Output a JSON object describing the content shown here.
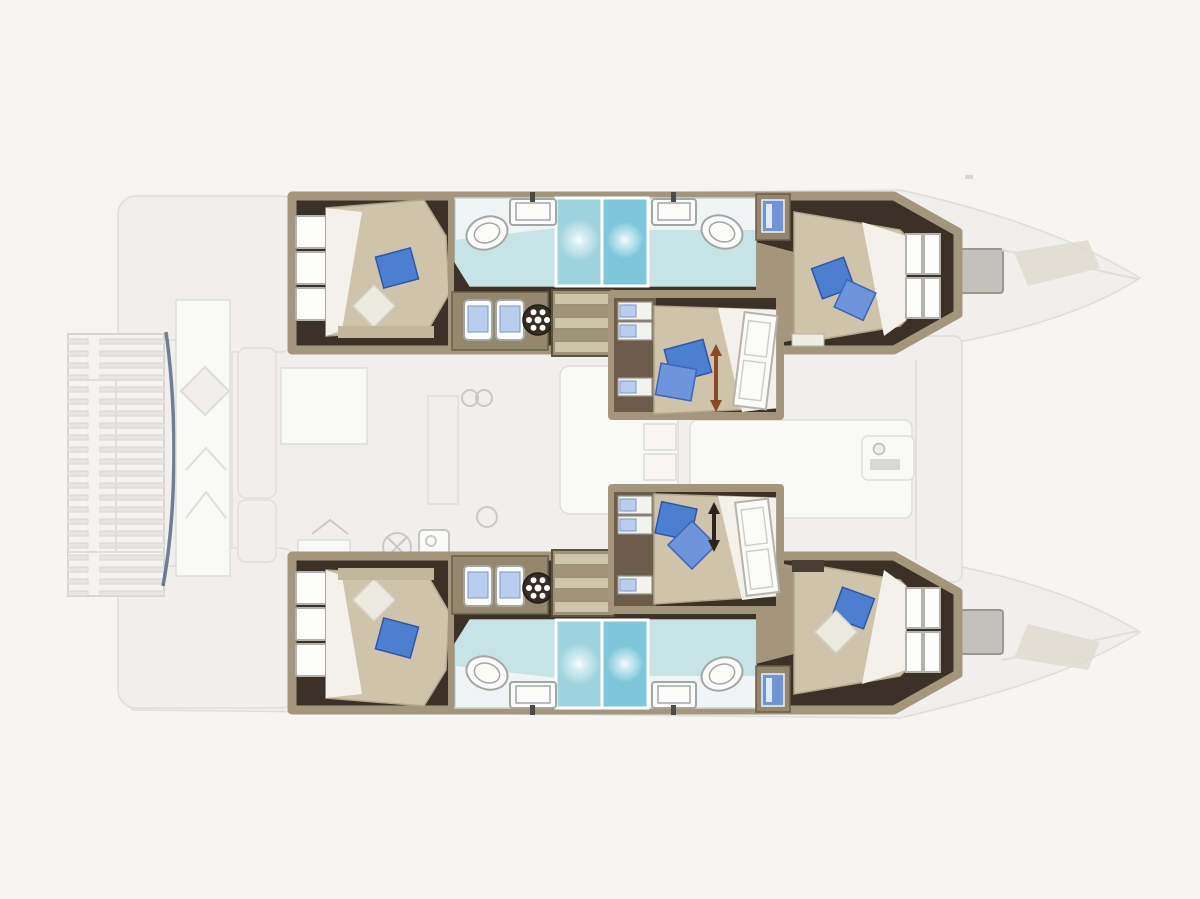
{
  "page": {
    "description": "Top-down interior layout plan of a sailing catamaran: six double cabins, four bathrooms with showers, twin staircases, saloon and galley (upper deck shown faded), slatted stern platform at left, twin bows with deck hatches at right."
  },
  "colors": {
    "canvas": "#f6f5f3",
    "ghost-fill": "#f0efed",
    "ghost-stroke": "#dfddd8",
    "floor-dark": "#3c3127",
    "floor-mid": "#6d5f4e",
    "wall-tan": "#a3967c",
    "wall-tan-light": "#c2b69d",
    "cabinet-tan": "#94876d",
    "bed-beige": "#cfc3ab",
    "bed-beige-dark": "#b2a68c",
    "bed-white": "#f3f1ea",
    "pillow-blue": "#4d7fd0",
    "pillow-blue-light": "#6e94dc",
    "pillow-white": "#eceade",
    "aqua-light": "#c7e3e5",
    "aqua-mid": "#9fd4df",
    "aqua-deep": "#7ec7da",
    "fixture-white": "#f0f4f4",
    "fixture-stroke": "#a2a7a5",
    "sink-blue": "#b9cdee",
    "locker-blue": "#6f95d6",
    "arrow-orange": "#8a4a26",
    "arrow-dark": "#2c241c",
    "navy": "#49597a",
    "stair-light": "#cfc5ad",
    "stair-dark": "#a1947a",
    "hatch-grey": "#c2bfb9"
  },
  "plan": {
    "vessel-type": "catamaran",
    "view": "top-down interior deck plan, bows to the right",
    "cabins": [
      {
        "id": "port-aft-cabin",
        "hull": "port (top)",
        "bed": "double",
        "pillows": {
          "blue": 1,
          "white": 1
        }
      },
      {
        "id": "port-forward-cabin",
        "hull": "port (top)",
        "bed": "double",
        "pillows": {
          "blue": 2,
          "white": 0
        }
      },
      {
        "id": "center-upper-cabin",
        "hull": "nacelle (middle)",
        "bed": "double",
        "pillows": {
          "blue": 2,
          "white": 0
        },
        "direction-arrow": "orange"
      },
      {
        "id": "center-lower-cabin",
        "hull": "nacelle (middle)",
        "bed": "double",
        "pillows": {
          "blue": 2,
          "white": 0
        },
        "direction-arrow": "black"
      },
      {
        "id": "starboard-aft-cabin",
        "hull": "starboard (bottom)",
        "bed": "double",
        "pillows": {
          "blue": 1,
          "white": 1
        }
      },
      {
        "id": "starboard-forward-cabin",
        "hull": "starboard (bottom)",
        "bed": "double",
        "pillows": {
          "blue": 1,
          "white": 1
        }
      }
    ],
    "bathrooms": [
      {
        "id": "port-aft-bathroom",
        "fixtures": [
          "toilet",
          "washbasin",
          "shower-stall"
        ]
      },
      {
        "id": "port-forward-bathroom",
        "fixtures": [
          "toilet",
          "washbasin",
          "shower-stall"
        ]
      },
      {
        "id": "starboard-aft-bathroom",
        "fixtures": [
          "toilet",
          "washbasin",
          "shower-stall"
        ]
      },
      {
        "id": "starboard-forward-bathroom",
        "fixtures": [
          "toilet",
          "washbasin",
          "shower-stall"
        ]
      }
    ],
    "features": [
      "slatted-stern-platform",
      "cockpit-table",
      "mast-and-boom-strip",
      "saloon-lounge",
      "galley",
      "twin-washbasin-vanities",
      "twin-companionway-stairs",
      "hanging-lockers",
      "bow-deck-hatches",
      "round-deck-wheels"
    ]
  },
  "icons": {
    "toilet-icon": "white oval bowl",
    "washbasin-icon": "white rectangle with dark faucet stub",
    "shower-icon": "aqua square with radial light glow",
    "stairs-icon": "block of striped steps",
    "wheel-hatch-icon": "dark circle ringed with white dots",
    "double-arrow-icon": "vertical double-headed arrow on bed",
    "hanging-locker-icon": "blue locker front in tan wardrobe",
    "deck-hatch-icon": "grey square hatch on foredeck",
    "trampoline-icon": "slatted rectangle",
    "bed-icon": "beige mattress with folded white sheet",
    "pillow-icon": "tilted square cushion"
  }
}
